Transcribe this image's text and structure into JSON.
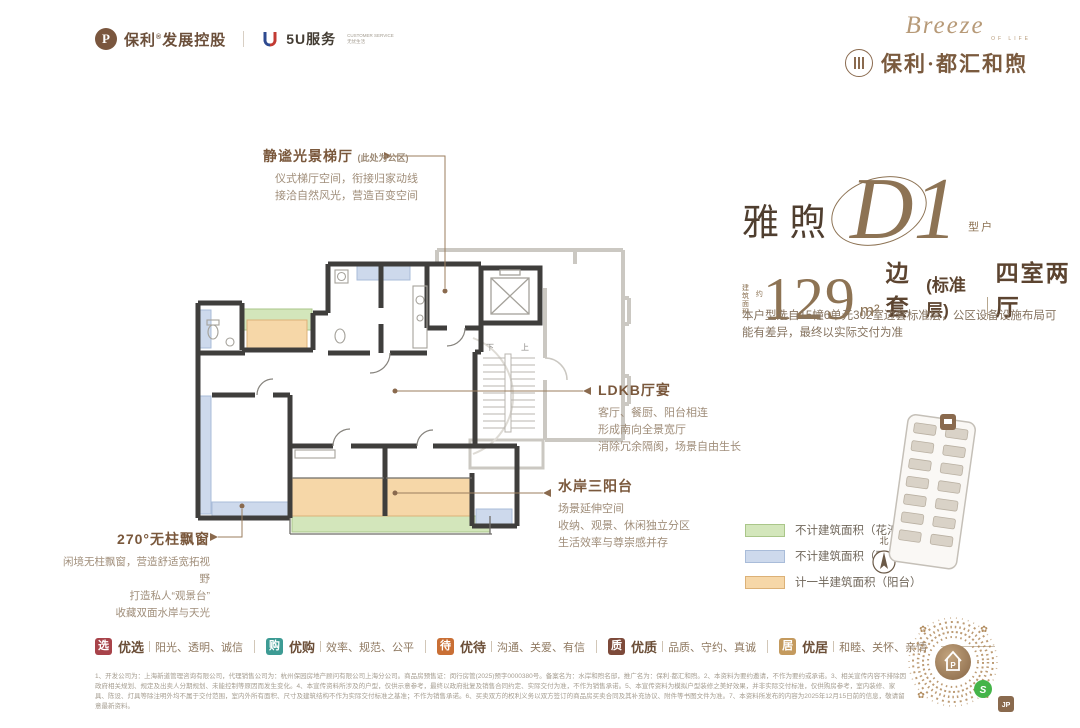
{
  "header": {
    "poly_mark": "P",
    "poly_brand": "保利",
    "poly_reg": "®",
    "poly_suffix": "发展控股",
    "service_logo": "U",
    "service_name": "5U服务",
    "service_sub1": "CUSTOMER SERVICE",
    "service_sub2": "无忧生活",
    "script": "Breeze",
    "script_sub": "OF LIFE",
    "brand_name": "保利·都汇和煦"
  },
  "unit": {
    "series": "雅煦",
    "code": "D1",
    "type_label_1": "户",
    "type_label_2": "型",
    "area_pre_1": "建筑",
    "area_pre_2": "面积",
    "area_approx": "约",
    "area_value": "129",
    "area_unit": "m²",
    "area_desc": "边套",
    "area_desc2": "(标准层)",
    "rooms": "四室两厅",
    "note": "本户型选自15幢6单元302室边套标准层，公区设备设施布局可能有差异，最终以实际交付为准"
  },
  "annotations": {
    "lobby": {
      "title": "静谧光景梯厅",
      "suffix": "(此处为公区)",
      "line1": "仪式梯厅空间，衔接归家动线",
      "line2": "接洽自然风光，营造百变空间"
    },
    "ldkb": {
      "title": "LDKB厅宴",
      "line1": "客厅、餐厨、阳台相连",
      "line2": "形成南向全景宽厅",
      "line3": "消除冗余隔阂，场景自由生长"
    },
    "balcony": {
      "title": "水岸三阳台",
      "line1": "场景延伸空间",
      "line2": "收纳、观景、休闲独立分区",
      "line3": "生活效率与尊崇感并存"
    },
    "window": {
      "title": "270°无柱飘窗",
      "line1": "闲境无柱飘窗，营造舒适宽拓视野",
      "line2": "打造私人“观景台”",
      "line3": "收藏双面水岸与天光"
    }
  },
  "plan": {
    "stair_down": "下",
    "stair_up": "上"
  },
  "legend": {
    "items": [
      {
        "label": "不计建筑面积（花池）",
        "color": "#d3e6bb"
      },
      {
        "label": "不计建筑面积（飘窗）",
        "color": "#cdd9ec"
      },
      {
        "label": "计一半建筑面积（阳台）",
        "color": "#f6d7a8"
      }
    ],
    "compass_label": "北"
  },
  "badges": {
    "items": [
      {
        "char": "选",
        "color": "#a8434a",
        "title": "优选",
        "desc": "阳光、透明、诚信"
      },
      {
        "char": "购",
        "color": "#3d9b94",
        "title": "优购",
        "desc": "效率、规范、公平"
      },
      {
        "char": "待",
        "color": "#c96f35",
        "title": "优待",
        "desc": "沟通、关爱、有信"
      },
      {
        "char": "质",
        "color": "#7d4a3a",
        "title": "优质",
        "desc": "品质、守约、真诚"
      },
      {
        "char": "居",
        "color": "#c49a5e",
        "title": "优居",
        "desc": "和睦、关怀、亲情"
      }
    ]
  },
  "disclaimer": {
    "text": "1、开发公司为：上海新道管理咨询有限公司，代理销售公司为：杭州保园房地产顾问有限公司上海分公司。商品房预售证：闵行房管(2025)预字0000380号。备案名为：水岸和煦名邸，推广名为：保利·都汇和煦。2、本资料为要约邀请，不作为要约或承诺。3、相关宣传内容不排除因政府相关规划、规定及出卖人分期规划、未能控制等原因而发生变化。4、本宣传资料所涉及的户型，仅供示意参考，最终以政府批复及销售合同约定、实际交付为准，不作为销售承诺。5、本宣传资料为模拟户型装修之美好效果，并非实际交付标准，仅供购房参考，室内装修、家具、陈设、灯具等除注明外均不属于交付范围，室内外所有面积、尺寸及建筑结构不作为实际交付标准之基准；不作为销售承诺。6、买卖双方的权利义务以双方签订的商品房买卖合同及其补充协议、附件等书图文件为准。7、本资料所发布的内容为2025年12月15日前的信息，敬请留意最新资料。"
  },
  "qr": {
    "center_glyph": "P",
    "wechat_badge": "S",
    "stamp_label": "JP"
  }
}
